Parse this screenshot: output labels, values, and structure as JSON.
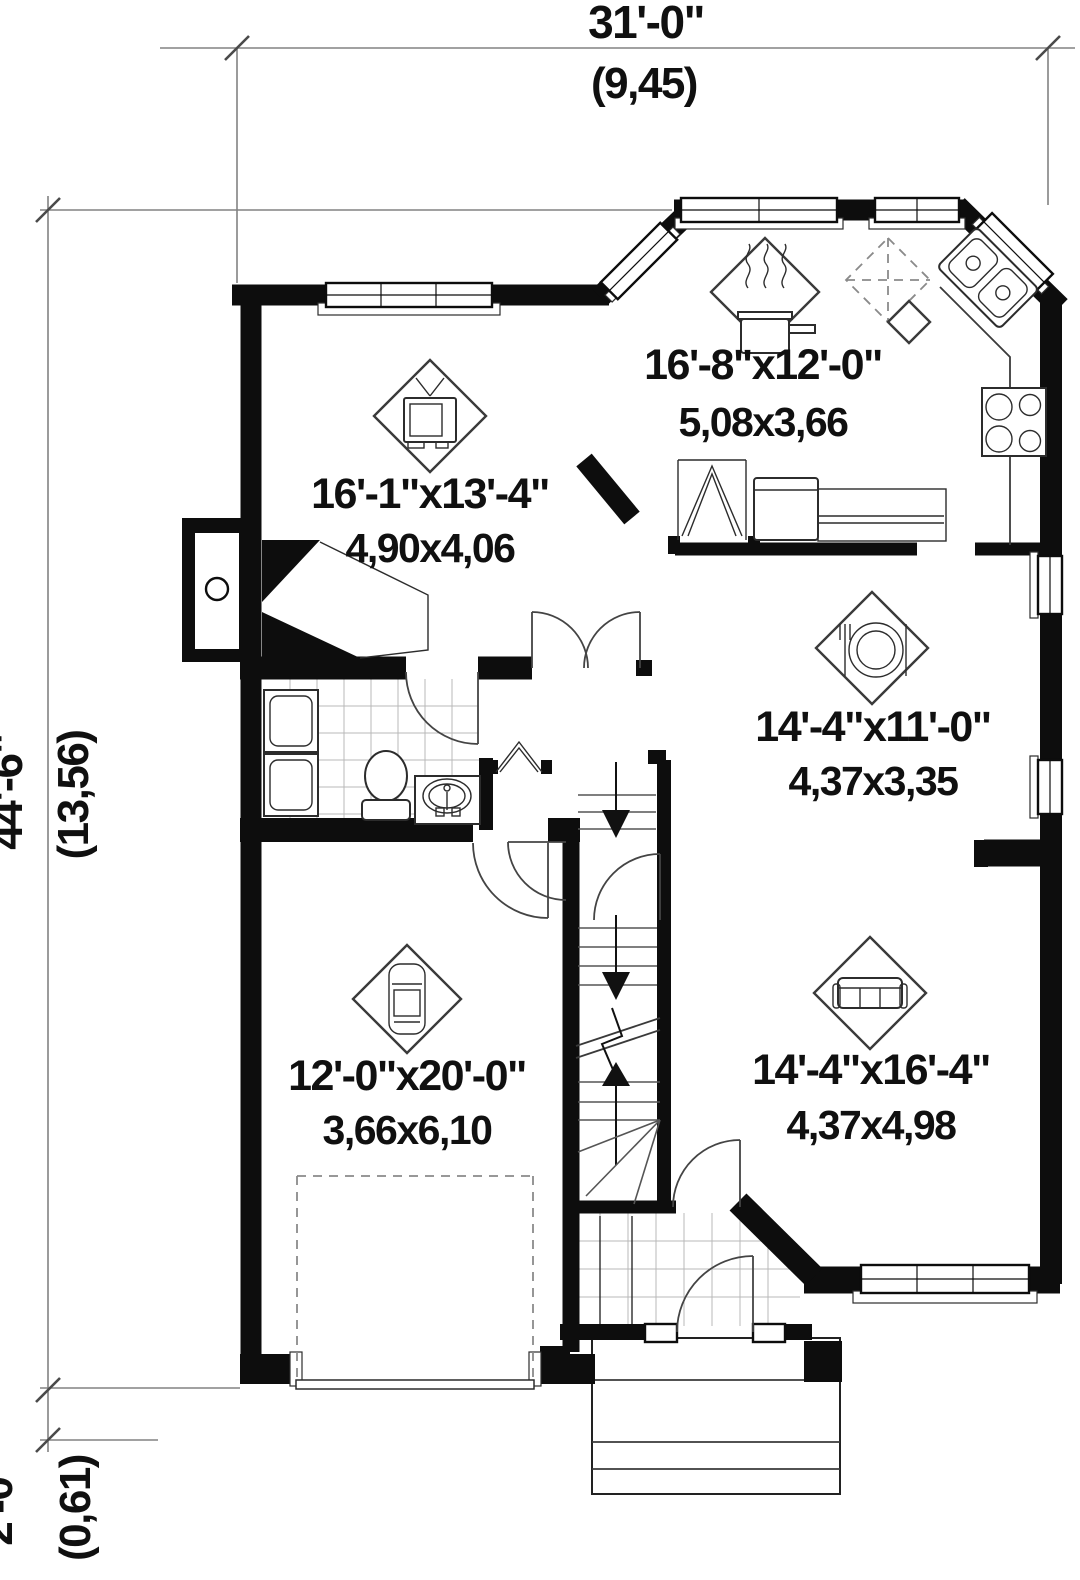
{
  "drawing": {
    "type": "house-floor-plan-first-floor"
  },
  "dimensions": {
    "top": {
      "imperial": "31'-0\"",
      "metric": "(9,45)"
    },
    "left": {
      "imperial": "44'-6\"",
      "metric": "(13,56)"
    },
    "bottom_left": {
      "imperial": "2'-0\"",
      "metric": "(0,61)"
    }
  },
  "rooms": {
    "living": {
      "imperial": "16'-1\"x13'-4\"",
      "metric": "4,90x4,06",
      "icon": "tv-icon"
    },
    "kitchen": {
      "imperial": "16'-8\"x12'-0\"",
      "metric": "5,08x3,66",
      "icon": "cooking-pot-icon"
    },
    "dining": {
      "imperial": "14'-4\"x11'-0\"",
      "metric": "4,37x3,35",
      "icon": "place-setting-icon"
    },
    "family": {
      "imperial": "14'-4\"x16'-4\"",
      "metric": "4,37x4,98",
      "icon": "sofa-icon"
    },
    "garage": {
      "imperial": "12'-0\"x20'-0\"",
      "metric": "3,66x6,10",
      "icon": "car-icon"
    }
  },
  "colors": {
    "background": "#ffffff",
    "walls": "#0d0d0d",
    "thin_lines": "#3a3a3a",
    "tile_lines": "#b8b8b8",
    "dimension_lines": "#828282",
    "text": "#101010"
  }
}
